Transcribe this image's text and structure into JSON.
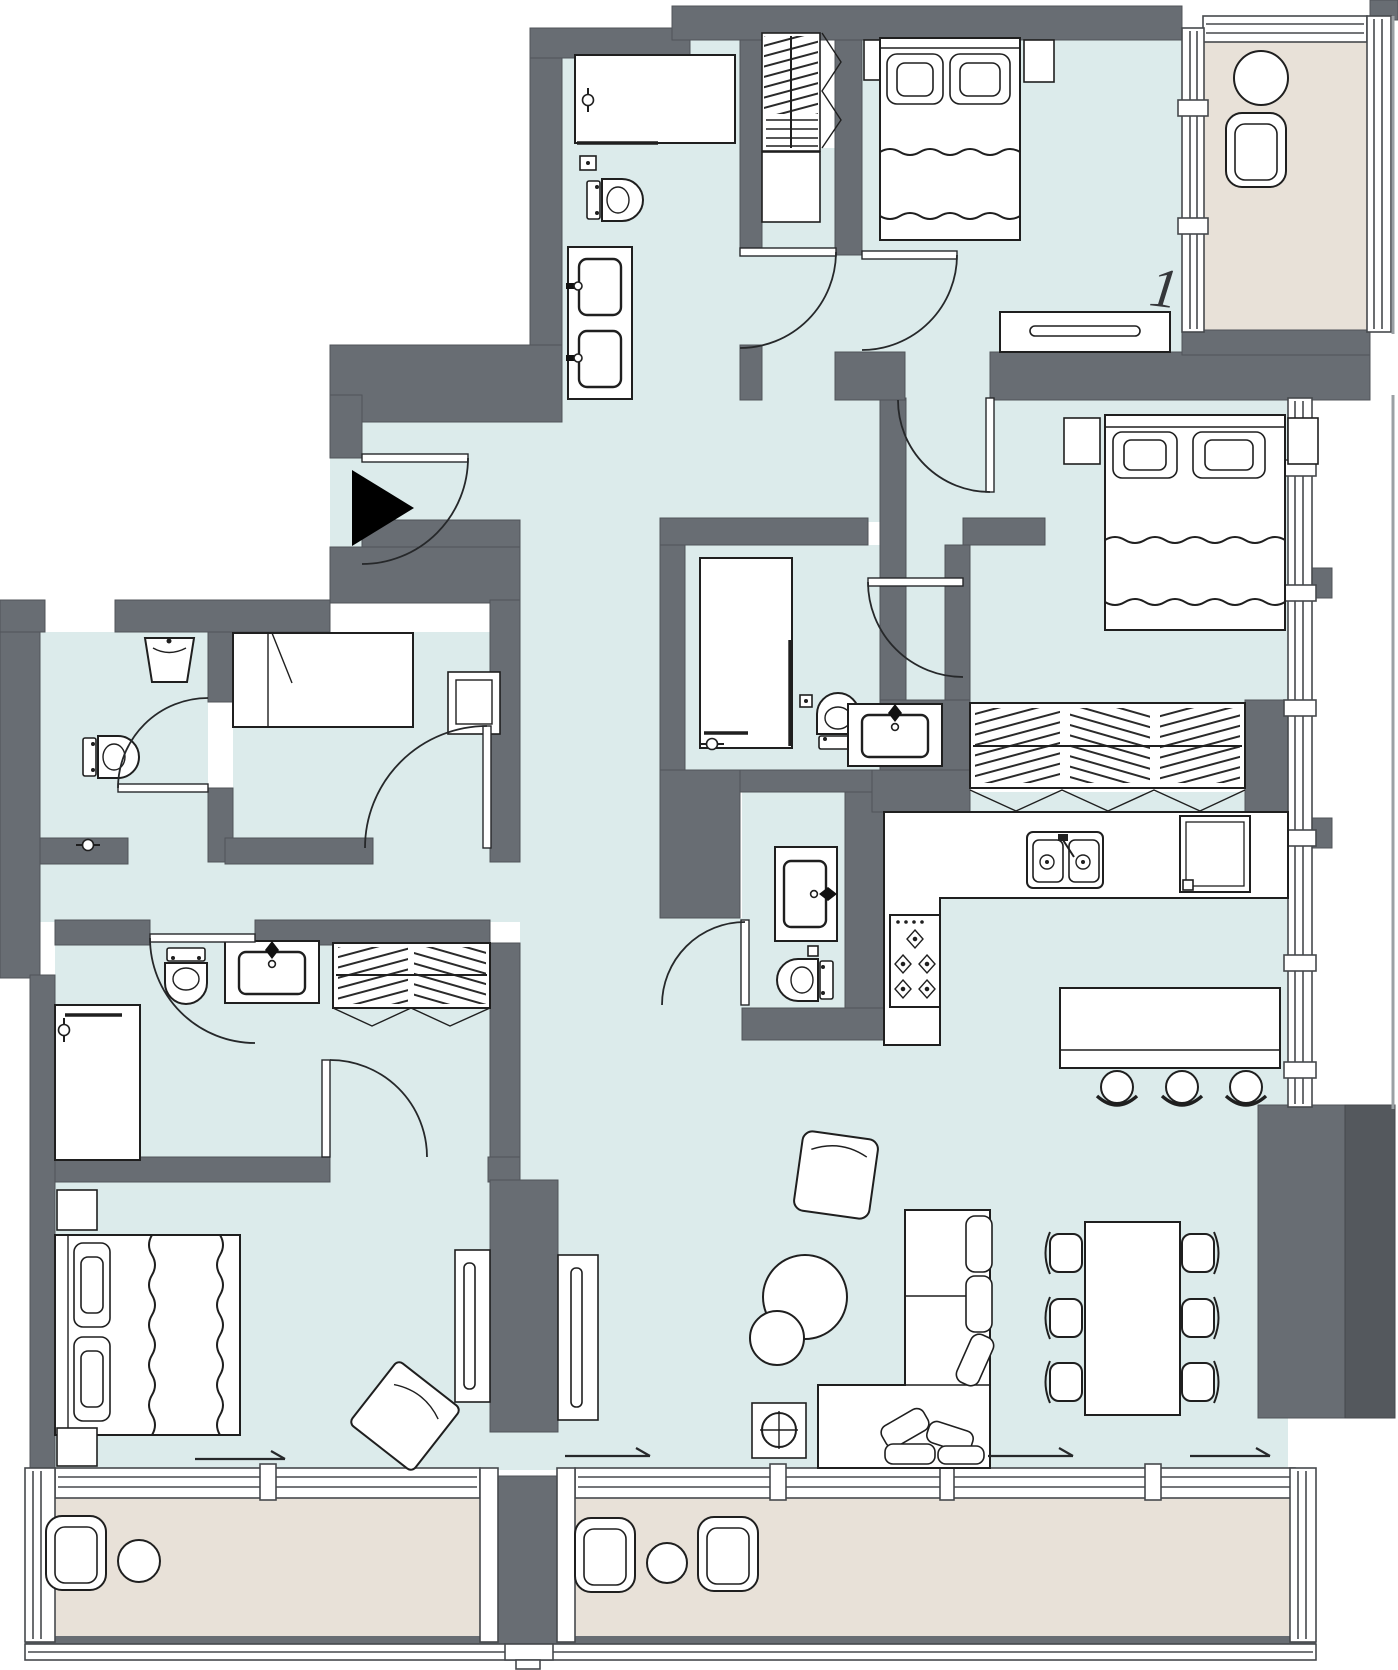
{
  "plan": {
    "unit_label": "1"
  },
  "colors": {
    "wall": "#686d73",
    "wall-dark": "#54585d",
    "floor": "#dcebeb",
    "balcony": "#e8e1d8",
    "outline": "#1f1f1f",
    "frame": "#46494d",
    "fixture": "#ffffff",
    "marker": "#000000"
  },
  "icons": {
    "entrance": "entrance-direction-arrow",
    "sliding_door": "slide-direction-arrow"
  }
}
